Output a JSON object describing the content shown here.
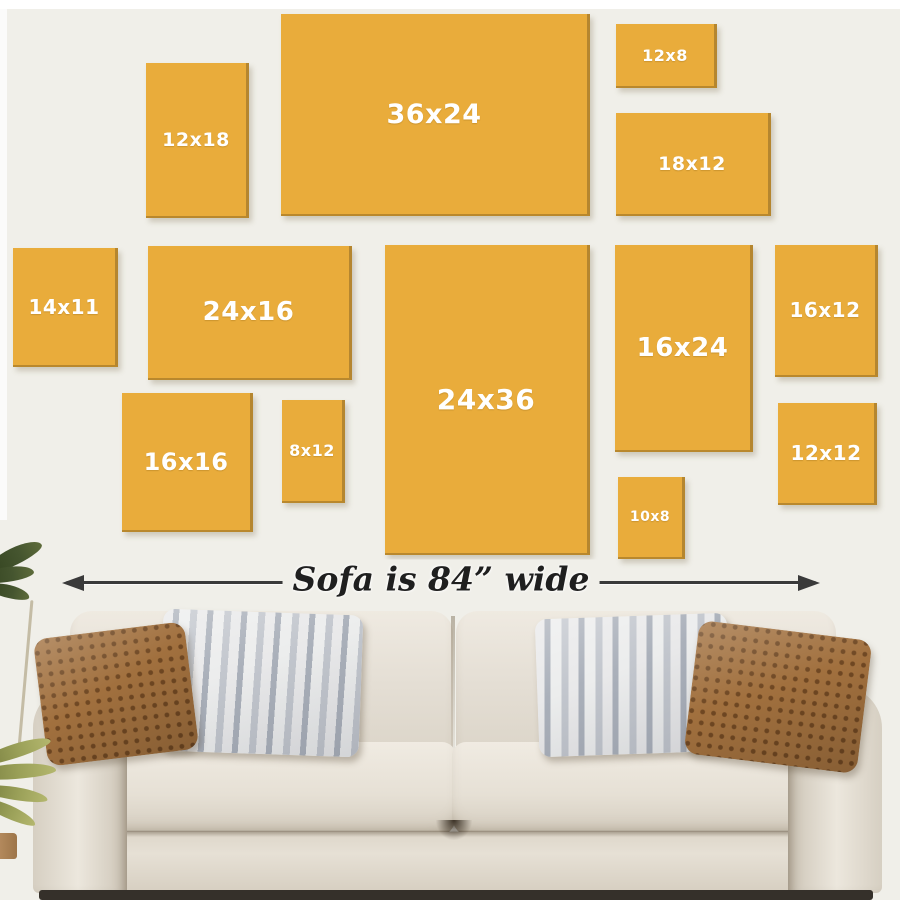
{
  "title": "Canvas size guide above a sofa",
  "colors": {
    "background": "#f0efe9",
    "frame": "#ffffff",
    "canvas_fill": "#e9ac3b",
    "canvas_edge": "#b5862f",
    "canvas_label": "#ffffff",
    "arrow": "#3a3a3a",
    "measure_text": "#1f1f1f",
    "sofa_fabric": "#e4ded4",
    "sofa_fabric_dark": "#cfc7ba",
    "sofa_shadow": "#35302a",
    "pillow_rust": "#a1703e",
    "pillow_rust_dark": "#6f4722",
    "pillow_stripe_light": "#e9e9ea",
    "pillow_stripe_dark": "#aab0ba",
    "plant_dark": "#45552f",
    "plant_olive": "#9aa058",
    "pot": "#b98f62"
  },
  "sizes": [
    {
      "label": "12x18",
      "x": 146,
      "y": 63,
      "w": 103,
      "h": 155,
      "fs": 19
    },
    {
      "label": "36x24",
      "x": 281,
      "y": 14,
      "w": 309,
      "h": 202,
      "fs": 27
    },
    {
      "label": "12x8",
      "x": 616,
      "y": 24,
      "w": 101,
      "h": 64,
      "fs": 16
    },
    {
      "label": "18x12",
      "x": 616,
      "y": 113,
      "w": 155,
      "h": 103,
      "fs": 19
    },
    {
      "label": "14x11",
      "x": 13,
      "y": 248,
      "w": 105,
      "h": 119,
      "fs": 20
    },
    {
      "label": "24x16",
      "x": 148,
      "y": 246,
      "w": 204,
      "h": 134,
      "fs": 26
    },
    {
      "label": "24x36",
      "x": 385,
      "y": 245,
      "w": 205,
      "h": 310,
      "fs": 28
    },
    {
      "label": "16x24",
      "x": 615,
      "y": 245,
      "w": 138,
      "h": 207,
      "fs": 26
    },
    {
      "label": "16x12",
      "x": 775,
      "y": 245,
      "w": 103,
      "h": 132,
      "fs": 20
    },
    {
      "label": "16x16",
      "x": 122,
      "y": 393,
      "w": 131,
      "h": 139,
      "fs": 24
    },
    {
      "label": "8x12",
      "x": 282,
      "y": 400,
      "w": 63,
      "h": 103,
      "fs": 16
    },
    {
      "label": "10x8",
      "x": 618,
      "y": 477,
      "w": 67,
      "h": 82,
      "fs": 14
    },
    {
      "label": "12x12",
      "x": 778,
      "y": 403,
      "w": 99,
      "h": 102,
      "fs": 20
    }
  ],
  "measure": {
    "text": "Sofa is 84” wide",
    "arrow_x1": 66,
    "arrow_x2": 816,
    "arrow_y": 582
  }
}
